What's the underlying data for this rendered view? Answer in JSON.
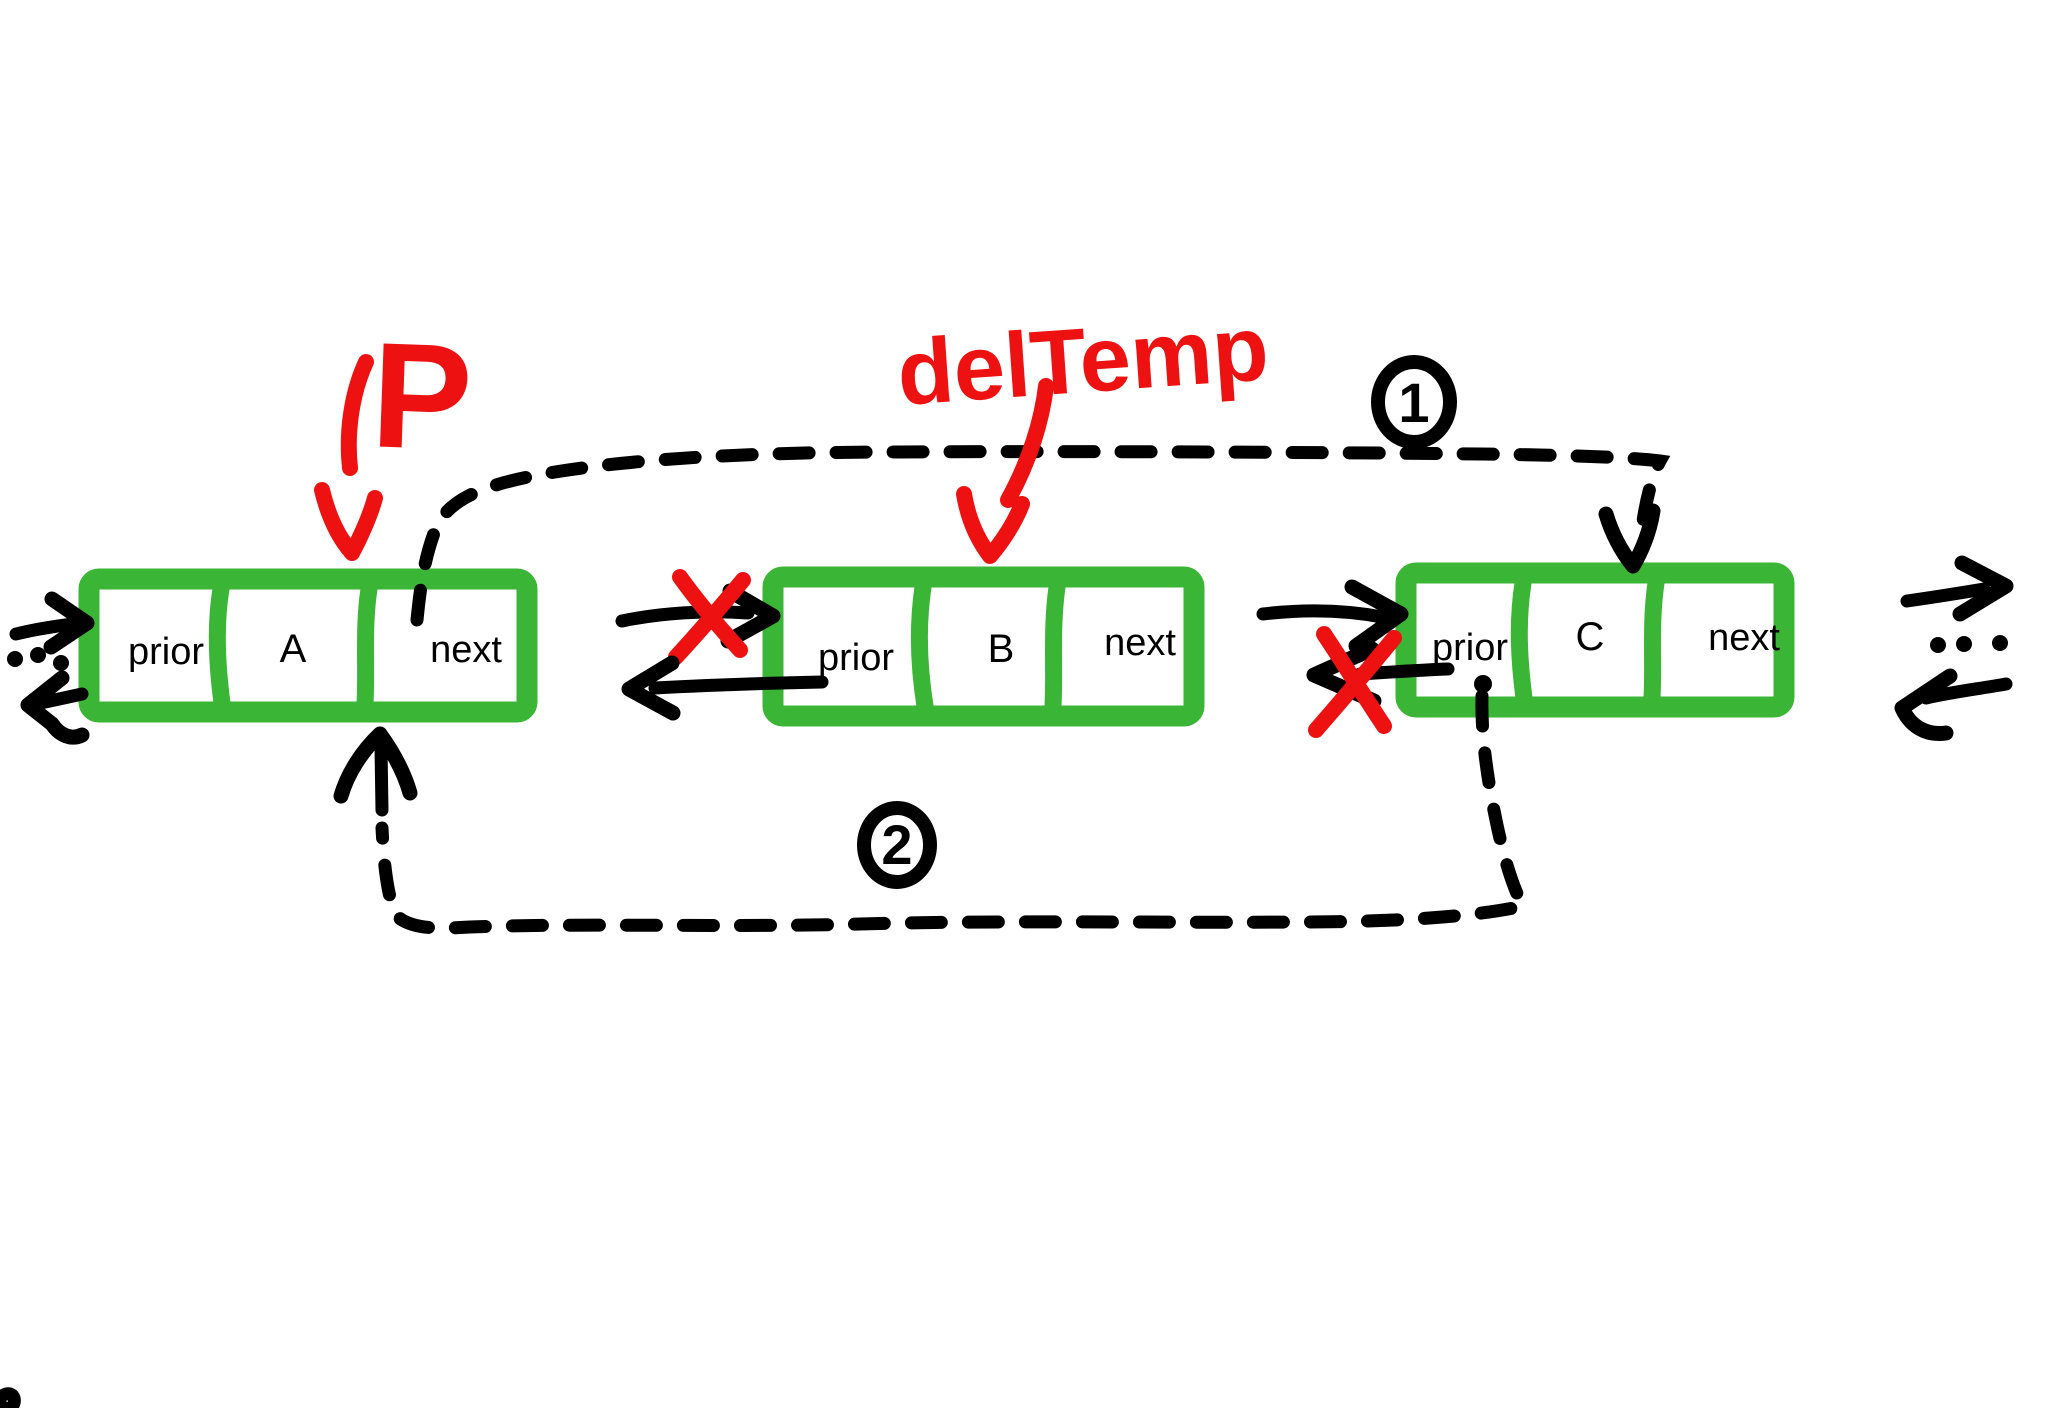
{
  "nodes": [
    {
      "id": "A",
      "prior_label": "prior",
      "value": "A",
      "next_label": "next"
    },
    {
      "id": "B",
      "prior_label": "prior",
      "value": "B",
      "next_label": "next"
    },
    {
      "id": "C",
      "prior_label": "prior",
      "value": "C",
      "next_label": "next"
    }
  ],
  "annotations": {
    "pointer": "P",
    "temp_pointer": "delTemp",
    "step_1": "1",
    "step_2": "2"
  },
  "colors": {
    "node_green": "#3ab535",
    "annotation_red": "#ee1111",
    "ink_black": "#000000",
    "background": "#ffffff"
  }
}
